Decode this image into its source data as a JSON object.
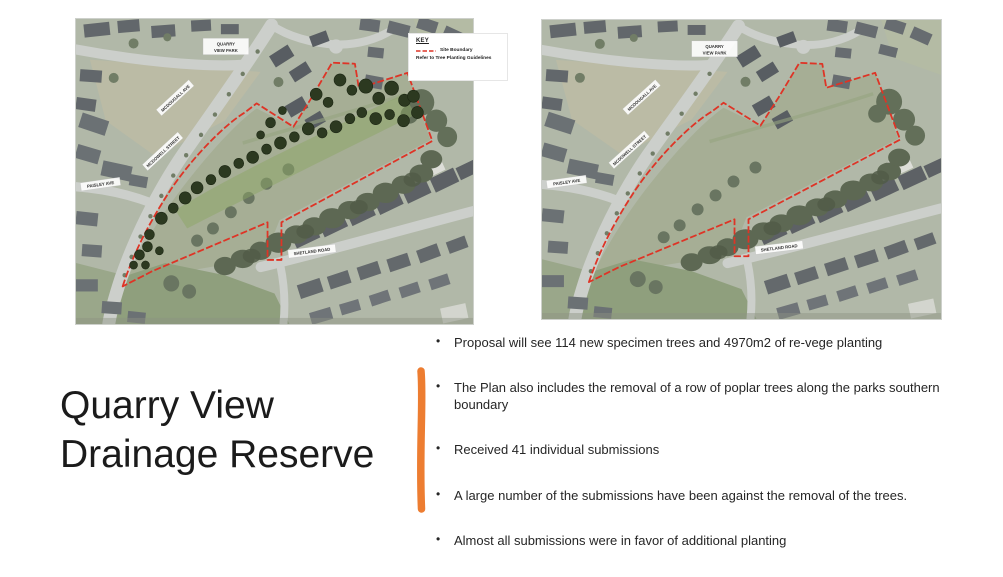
{
  "slide": {
    "title": "Quarry View Drainage Reserve",
    "bullet_glyph": "•",
    "accent_color": "#ED7D31",
    "text_color": "#262626"
  },
  "bullets": [
    "Proposal will see 114 new specimen trees and 4970m2 of re-vege planting",
    "The Plan also includes the removal of a row of poplar trees along the parks southern boundary",
    "Received 41 individual submissions",
    "A large number of the submissions have been against the removal of the trees.",
    "Almost all submissions were in favor of additional planting"
  ],
  "maps": {
    "boundary_color": "#DE3426",
    "key": {
      "title": "KEY",
      "item1_label": "Site Boundary",
      "item2_label": "Refer to Tree Planting Guidelines"
    },
    "left": {
      "park_label_line1": "QUARRY",
      "park_label_line2": "VIEW PARK",
      "street_diag_upper": "MCDOUGALL AVE",
      "street_diag_lower": "MCDOWELL STREET",
      "street_left": "PAISLEY AVE",
      "street_bottom": "SHETLAND ROAD"
    },
    "right": {
      "park_label_line1": "QUARRY",
      "park_label_line2": "VIEW PARK",
      "street_diag_upper": "MCDOUGALL AVE",
      "street_diag_lower": "MCDOWELL STREET",
      "street_left": "PAISLEY AVE",
      "street_bottom": "SHETLAND ROAD"
    }
  }
}
